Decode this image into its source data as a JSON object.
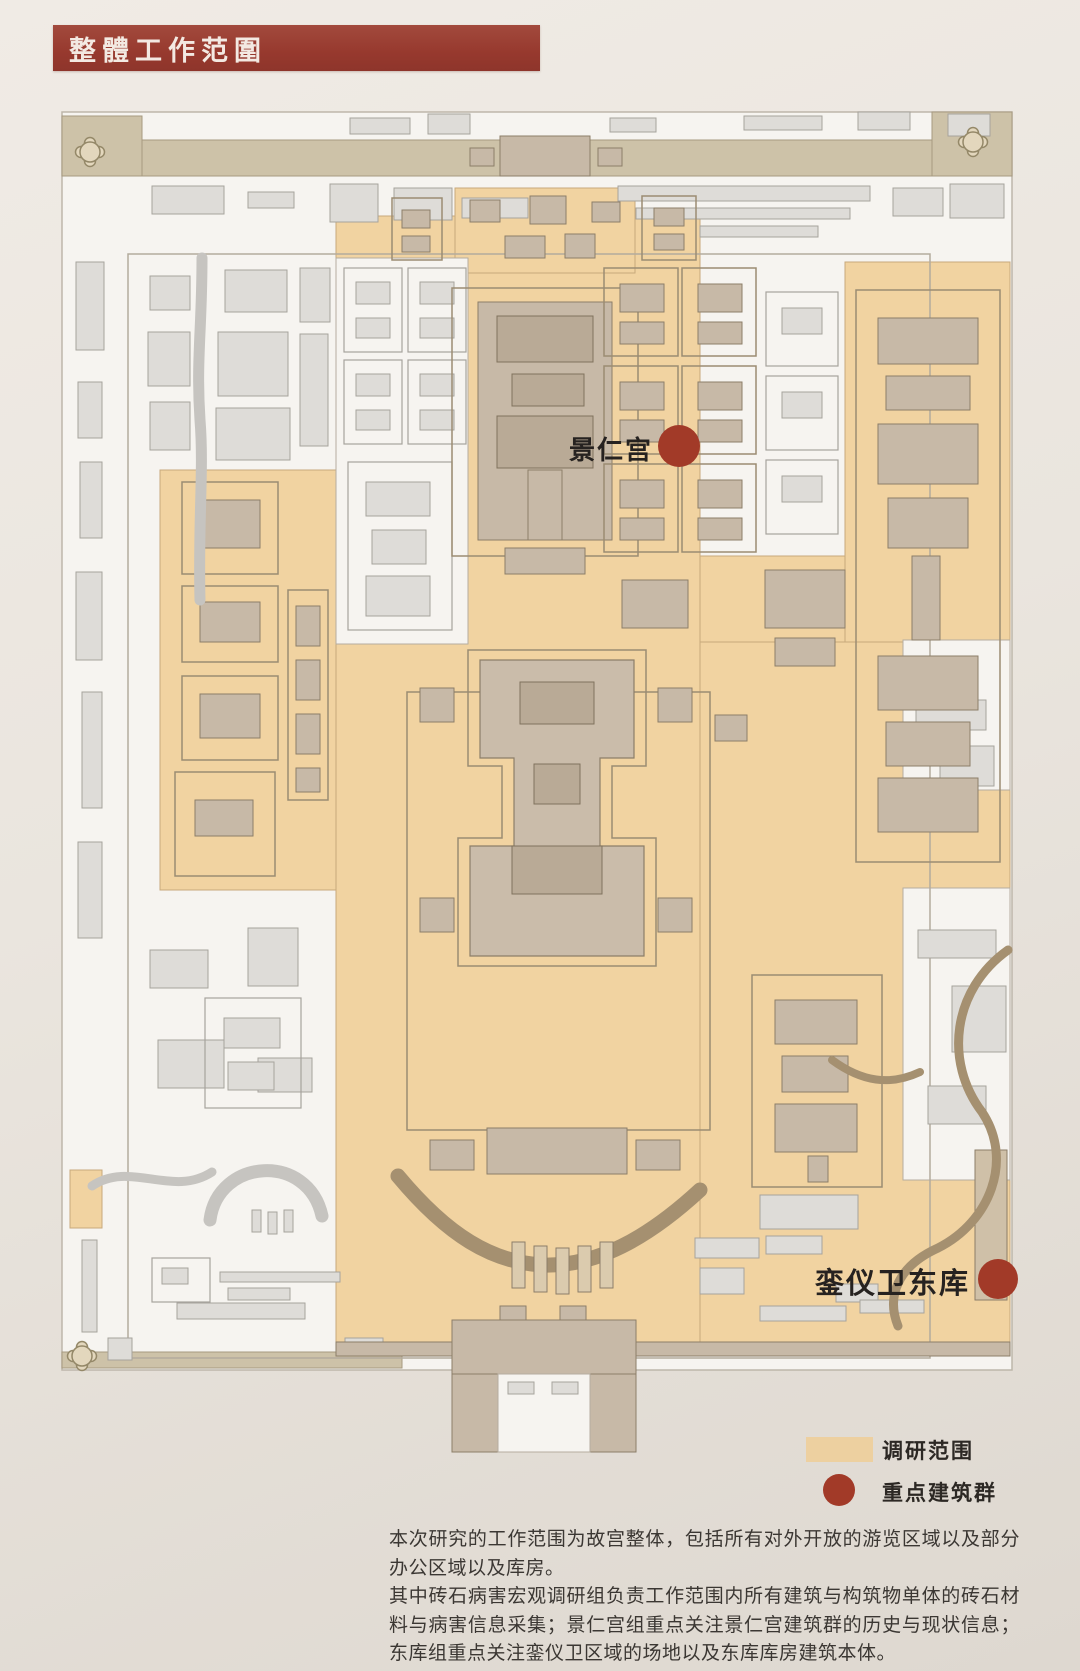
{
  "title": {
    "label": "整體工作范圍"
  },
  "map": {
    "markers": [
      {
        "label": "景仁宫"
      },
      {
        "label": "銮仪卫东库"
      }
    ],
    "legend": {
      "items": [
        {
          "label": "调研范围",
          "swatch": "survey-area-swatch"
        },
        {
          "label": "重点建筑群",
          "swatch": "key-building-swatch"
        }
      ]
    }
  },
  "description": {
    "paragraphs": [
      "本次研究的工作范围为故宫整体，包括所有对外开放的游览区域以及部分办公区域以及库房。",
      "其中砖石病害宏观调研组负责工作范围内所有建筑与构筑物单体的砖石材料与病害信息采集；景仁宫组重点关注景仁宫建筑群的历史与现状信息；东库组重点关注銮仪卫区域的场地以及东库库房建筑本体。"
    ]
  },
  "colors": {
    "banner": "#97392e",
    "page_background": "#eae5de",
    "survey_area": "#edd0a0",
    "key_marker": "#a23a28",
    "wall_band": "#cdc2a8",
    "building_gray": "#dedcd8",
    "building_tan": "#c7b9a7",
    "river": "#a59070",
    "text": "#3b3733"
  }
}
